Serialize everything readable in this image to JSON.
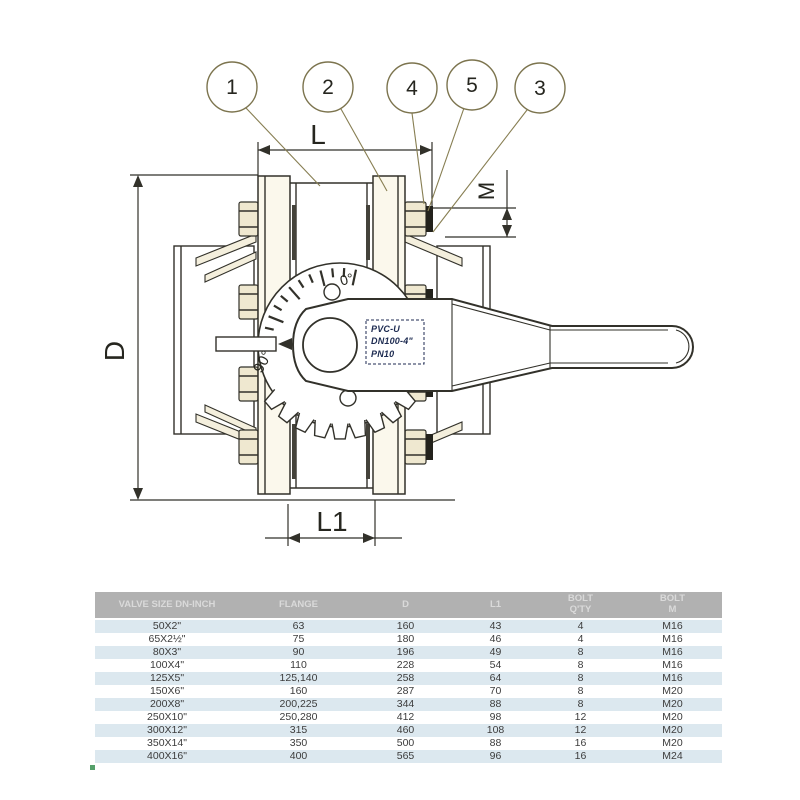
{
  "colors": {
    "line": "#32312a",
    "leader": "#877e52",
    "label-navy": "#1c2a50",
    "table-header-bg": "#b1b1b1",
    "table-header-text": "#dadada",
    "row-blue": "#dce8ef",
    "row-white": "#ffffff",
    "row-text": "#3c3c3c",
    "green-dot": "#55a06a",
    "cream": "#efe8d0",
    "dark-fill": "#23221c"
  },
  "drawing": {
    "balloons": [
      "1",
      "2",
      "4",
      "5",
      "3"
    ],
    "dims": {
      "L": "L",
      "D": "D",
      "M": "M",
      "L1": "L1"
    },
    "dial": {
      "zero": "0°",
      "ninety": "90°"
    },
    "handle_label": [
      "PVC-U",
      "DN100-4\"",
      "PN10"
    ]
  },
  "table": {
    "headers": [
      [
        "VALVE SIZE DN-INCH"
      ],
      [
        "FLANGE"
      ],
      [
        "D"
      ],
      [
        "L1"
      ],
      [
        "BOLT",
        "Q'TY"
      ],
      [
        "BOLT",
        "M"
      ]
    ],
    "rows": [
      [
        "50X2\"",
        "63",
        "160",
        "43",
        "4",
        "M16"
      ],
      [
        "65X2½\"",
        "75",
        "180",
        "46",
        "4",
        "M16"
      ],
      [
        "80X3\"",
        "90",
        "196",
        "49",
        "8",
        "M16"
      ],
      [
        "100X4\"",
        "110",
        "228",
        "54",
        "8",
        "M16"
      ],
      [
        "125X5\"",
        "125,140",
        "258",
        "64",
        "8",
        "M16"
      ],
      [
        "150X6\"",
        "160",
        "287",
        "70",
        "8",
        "M20"
      ],
      [
        "200X8\"",
        "200,225",
        "344",
        "88",
        "8",
        "M20"
      ],
      [
        "250X10\"",
        "250,280",
        "412",
        "98",
        "12",
        "M20"
      ],
      [
        "300X12\"",
        "315",
        "460",
        "108",
        "12",
        "M20"
      ],
      [
        "350X14\"",
        "350",
        "500",
        "88",
        "16",
        "M20"
      ],
      [
        "400X16\"",
        "400",
        "565",
        "96",
        "16",
        "M24"
      ]
    ]
  }
}
